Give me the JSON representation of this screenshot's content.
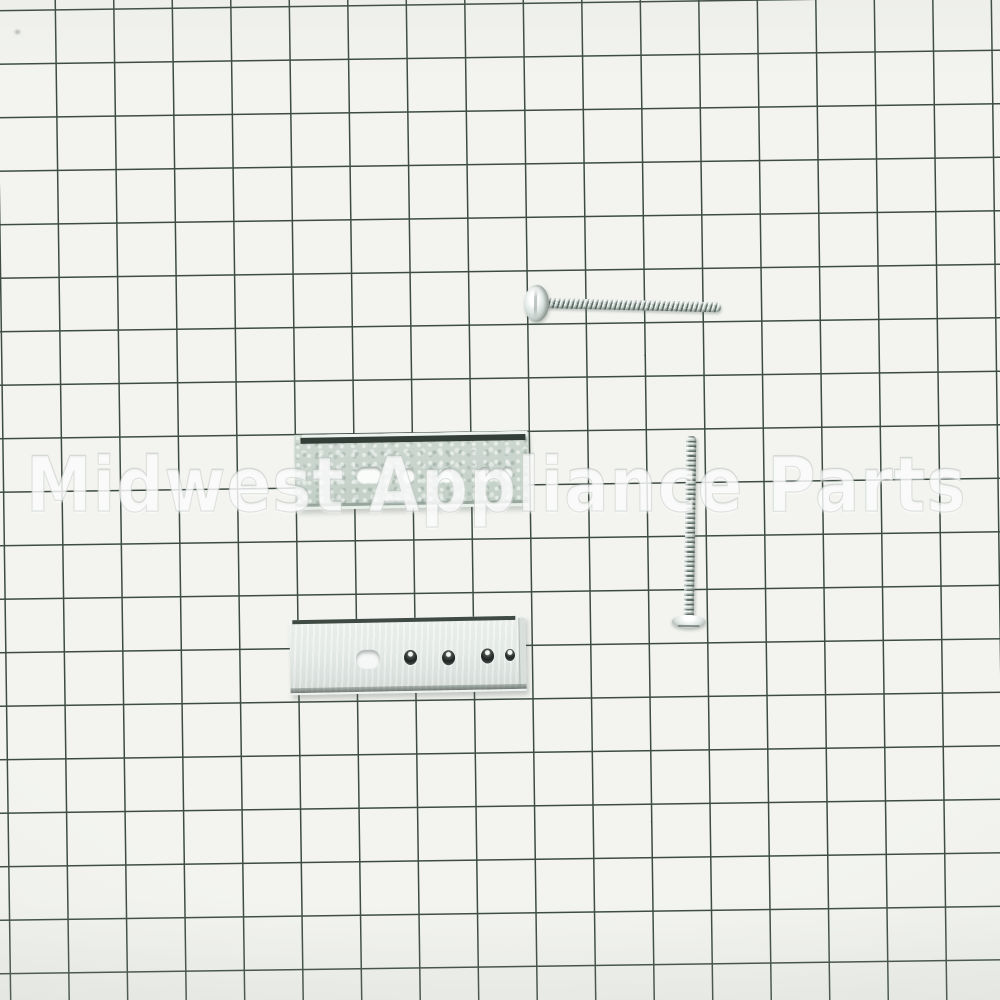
{
  "watermark": {
    "text": "Midwest Appliance Parts"
  },
  "colors": {
    "background": "#f3f4f0",
    "grid_line": "#3d4b44",
    "metal_dark_edge": "#333e38",
    "bracket_galvanized": "#c9d5cd",
    "bracket_polished": "#e9eeec",
    "screw_thread_dark": "#5f6e68",
    "screw_thread_light": "#eef3f0",
    "watermark_color": "#ffffff"
  },
  "parts": {
    "bracket_top": "galvanized mounting bracket with slot and four round holes",
    "bracket_bottom": "flat mounting bracket with slot and four countersunk holes",
    "screw_horizontal": "zinc pan head machine screw",
    "screw_vertical": "zinc truss head machine screw"
  }
}
